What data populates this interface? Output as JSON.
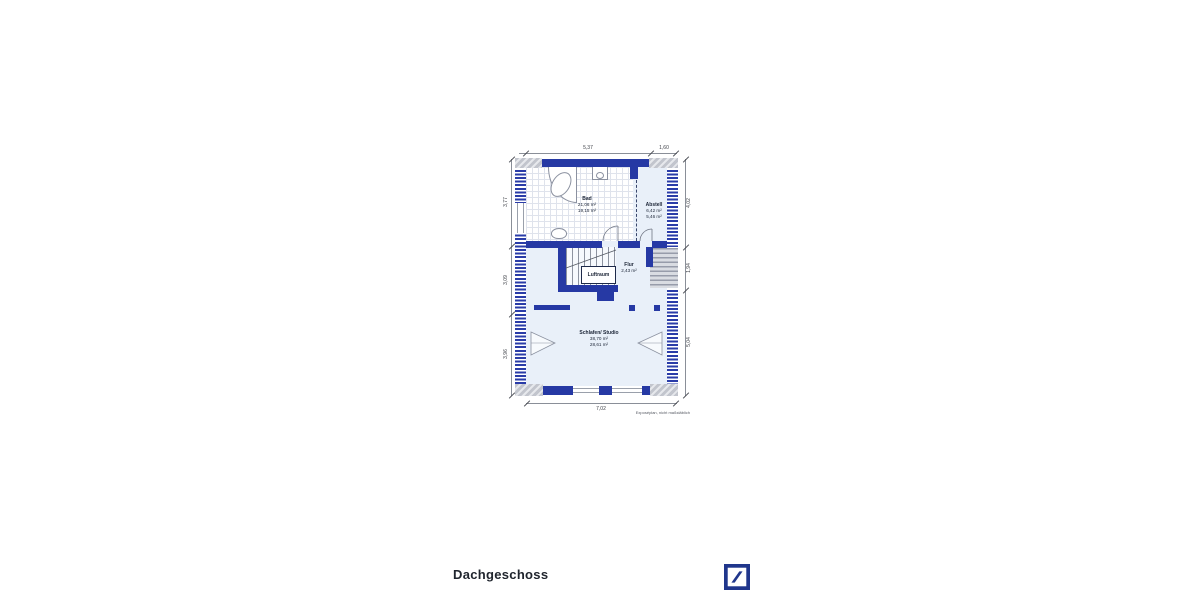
{
  "title": "Dachgeschoss",
  "footnote": "Exposéplan, nicht maßstäblich",
  "floorplan": {
    "rooms": {
      "bad": {
        "name": "Bad",
        "area_total": "21,06 m²",
        "area_living": "19,15 m²"
      },
      "abstell": {
        "name": "Abstell",
        "area_total": "6,42 m²",
        "area_living": "5,46 m²"
      },
      "flur": {
        "name": "Flur",
        "area_total": "2,43 m²"
      },
      "luftraum": {
        "name": "Luftraum"
      },
      "schlafen_studio": {
        "name": "Schlafen/ Studio",
        "area_total": "38,70 m²",
        "area_living": "28,61 m²"
      }
    },
    "dimensions_m": {
      "top": [
        "5,37",
        "1,60"
      ],
      "left": [
        "3,77",
        "3,09",
        "3,96"
      ],
      "right": [
        "4,02",
        "1,94",
        "5,04"
      ],
      "bottom": [
        "7,02"
      ]
    },
    "colors": {
      "wall_blue": "#2639a4",
      "floor_light": "#e9f0f9",
      "hatch_gray": "#c2c5cd",
      "logo_blue": "#20368c"
    }
  },
  "logo": {
    "name": "Deutsche Bank"
  }
}
